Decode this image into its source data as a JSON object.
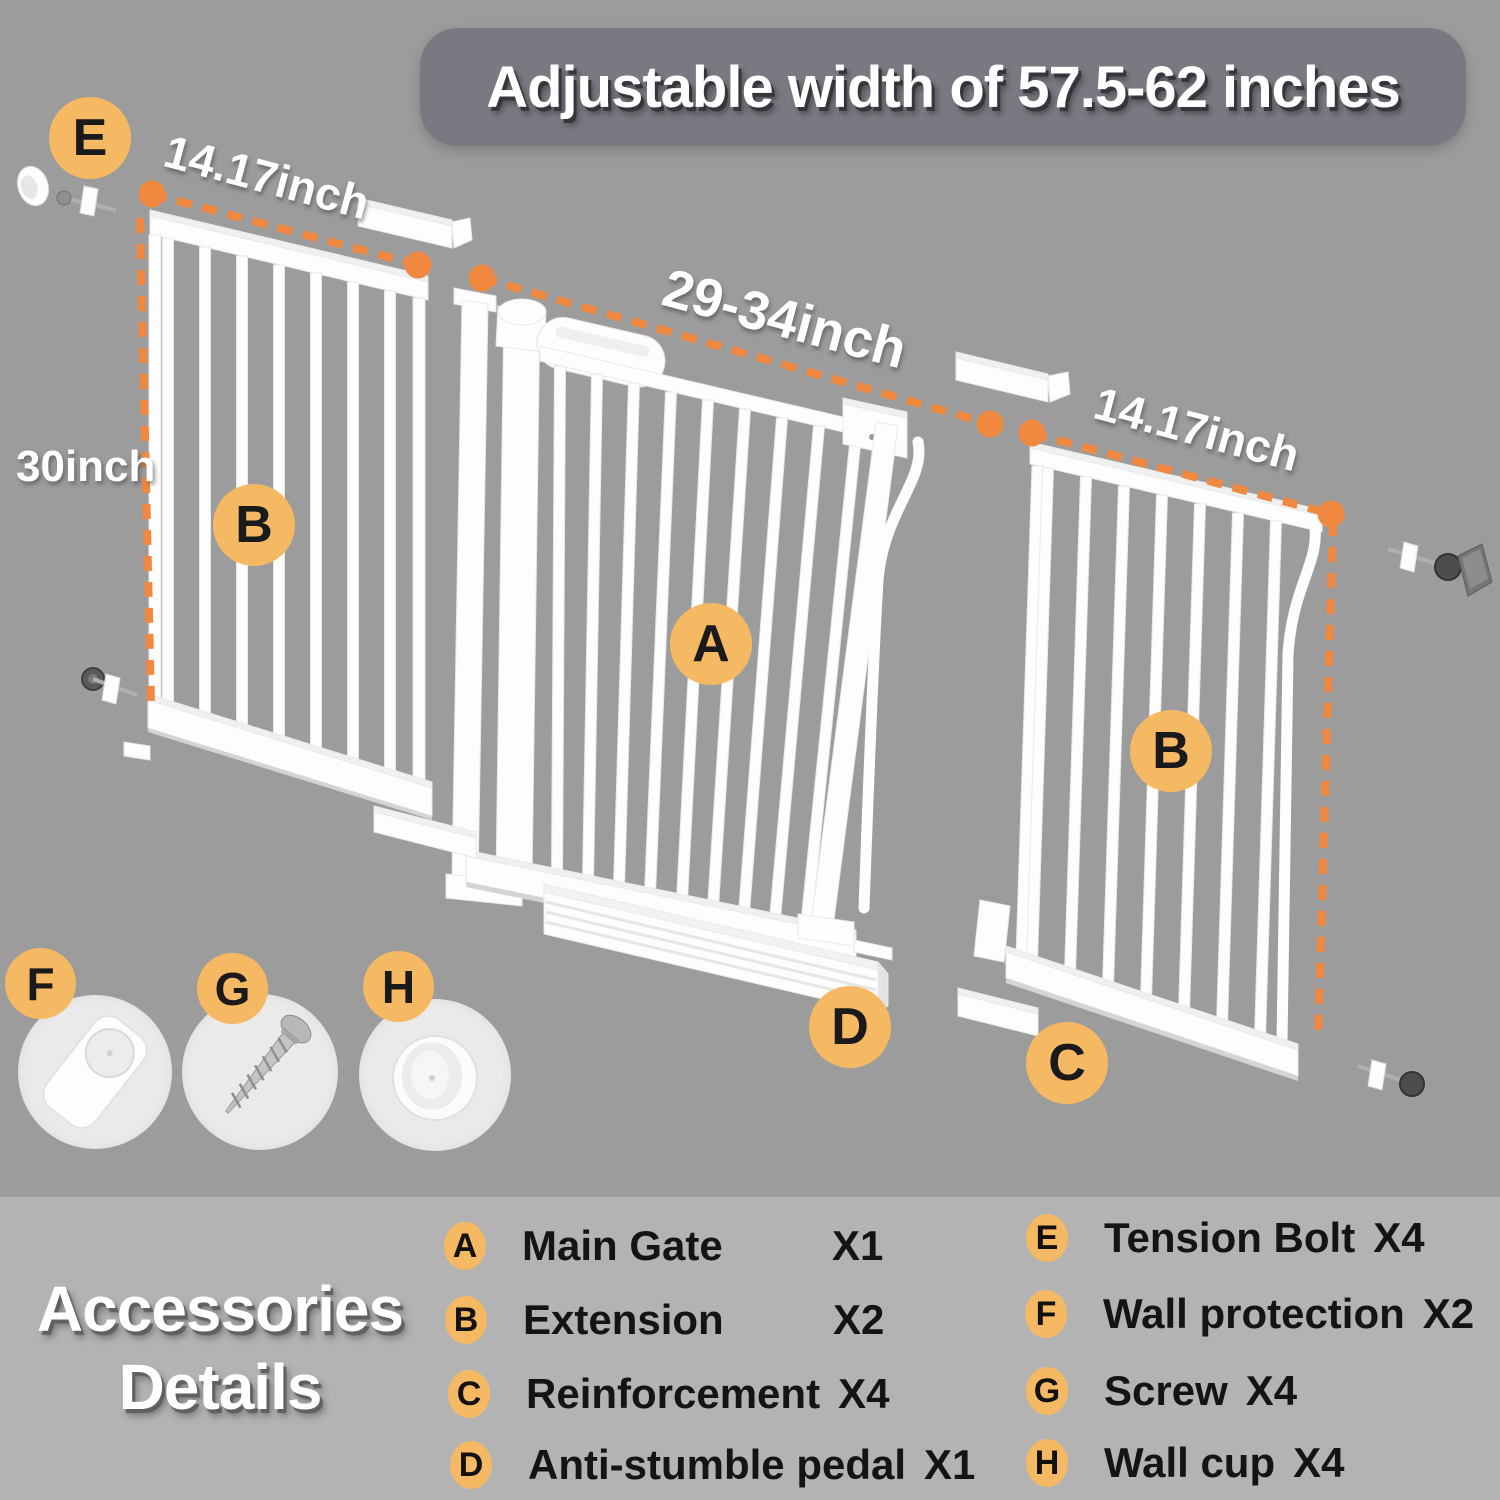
{
  "banner": {
    "title": "Adjustable width of 57.5-62 inches"
  },
  "dimensions": {
    "left_extension_width": "14.17inch",
    "panel_height": "30inch",
    "main_gate_width": "29-34inch",
    "right_extension_width": "14.17inch"
  },
  "diagram_markers": {
    "tension_bolt": "E",
    "extension_left": "B",
    "main_gate": "A",
    "extension_right": "B",
    "reinforcement": "C",
    "pedal": "D",
    "wall_protection": "F",
    "screw": "G",
    "wall_cup": "H"
  },
  "icons": {
    "f": "wall-protection",
    "g": "screw",
    "h": "wall-cup",
    "e": "tension-bolt"
  },
  "legend": {
    "title_line1": "Accessories",
    "title_line2": "Details",
    "left": [
      {
        "key": "A",
        "name": "Main Gate",
        "qty": "X1"
      },
      {
        "key": "B",
        "name": "Extension",
        "qty": "X2"
      },
      {
        "key": "C",
        "name": "Reinforcement",
        "qty": "X4"
      },
      {
        "key": "D",
        "name": "Anti-stumble pedal",
        "qty": "X1"
      }
    ],
    "right": [
      {
        "key": "E",
        "name": "Tension Bolt",
        "qty": "X4"
      },
      {
        "key": "F",
        "name": "Wall protection",
        "qty": "X2"
      },
      {
        "key": "G",
        "name": "Screw",
        "qty": "X4"
      },
      {
        "key": "H",
        "name": "Wall cup",
        "qty": "X4"
      }
    ]
  },
  "colors": {
    "background": "#9C9C9C",
    "legend_band": "#B3B3B3",
    "banner": "#797981",
    "accent_orange": "#F6B963",
    "dimension_orange": "#F08840",
    "gate_white": "#FDFDFD"
  }
}
